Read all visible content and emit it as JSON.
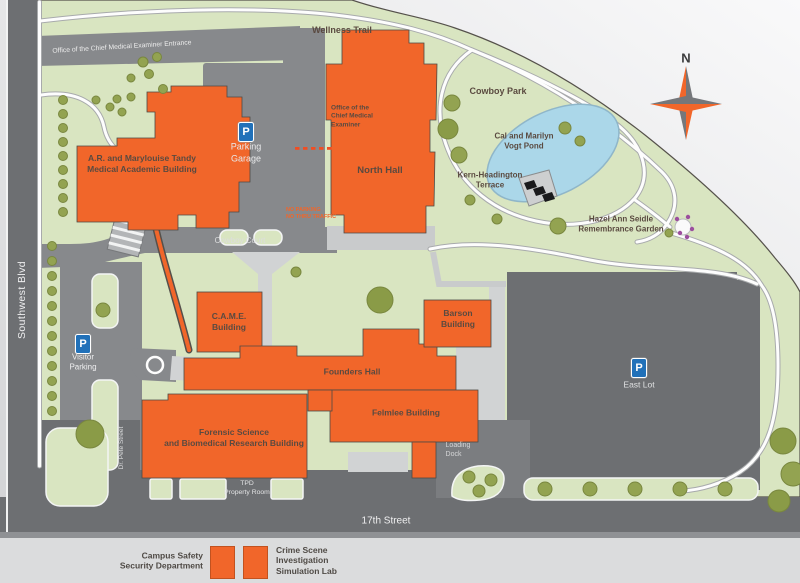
{
  "map": {
    "compass": {
      "north": "N"
    },
    "streets": {
      "southwest_blvd": "Southwest Blvd",
      "ocme_entrance": "Office of the Chief Medical Examiner Entrance",
      "wellness_trail": "Wellness Trail",
      "cowboy_court": "Cowboy Court",
      "dr_pete_street": "Dr. Pete Street",
      "seventeenth_street": "17th Street"
    },
    "buildings": {
      "tandy": "A.R. and Marylouise Tandy\nMedical Academic Building",
      "north_hall": "North Hall",
      "ocme_office": "Office of the\nChief Medical\nExaminer",
      "came": "C.A.M.E.\nBuilding",
      "barson": "Barson\nBuilding",
      "founders": "Founders Hall",
      "felmlee": "Felmlee Building",
      "forensic": "Forensic Science\nand Biomedical Research Building"
    },
    "parking": {
      "p_symbol": "P",
      "garage": "Parking\nGarage",
      "visitor": "Visitor\nParking",
      "east_lot": "East Lot"
    },
    "places": {
      "cowboy_park": "Cowboy Park",
      "vogt_pond": "Cal and Marilyn\nVogt Pond",
      "kern_terrace": "Kern-Headington\nTerrace",
      "remembrance_garden": "Hazel Ann Seidle\nRemembrance Garden"
    },
    "notices": {
      "no_parking": "NO PARKING\nNO THRU TRAFFIC",
      "tpd_property_room": "TPD\nProperty Room",
      "loading_dock": "Loading\nDock"
    },
    "legend": {
      "campus_safety": "Campus Safety\nSecurity Department",
      "crime_scene": "Crime Scene\nInvestigation\nSimulation Lab"
    },
    "colors": {
      "building_orange": "#F1662A",
      "campus_green": "#D9E5C1",
      "tree_olive": "#93A351",
      "road_gray": "#87898C",
      "street_dark_gray": "#6D6F72",
      "plaza_light": "#D1D3D4",
      "pond_blue": "#ABD7E9",
      "parking_blue": "#2171B9"
    }
  }
}
